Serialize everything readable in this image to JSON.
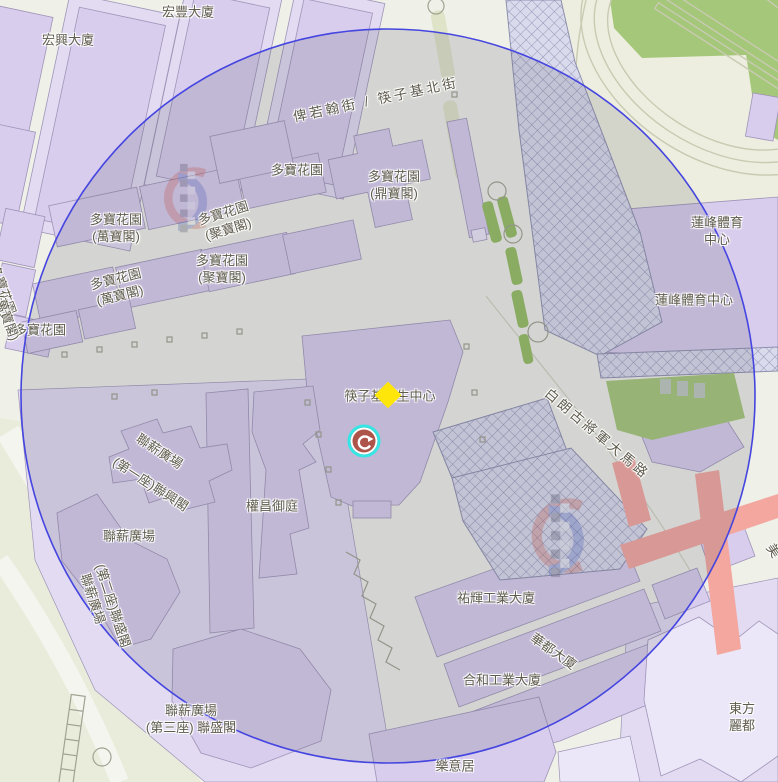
{
  "app": {
    "description": "street map with search radius"
  },
  "map": {
    "colors": {
      "base": "#EFF0E8",
      "ground": "#E9ECDB",
      "roadl": "#F4F5EE",
      "pod": "#E2DBF2",
      "bldg": "#D8CDED",
      "tower": "#ECE7F8",
      "bstroke": "#9F94B8",
      "track": "#C9CAB2",
      "green": "#A5C779",
      "gstrip": "#94BD62",
      "treegreen": "#DFE4C9",
      "hatchbg": "#D9DAEB",
      "hatchline": "#9597B8",
      "pink": "#F3A79F",
      "label": "#5F5B4D",
      "circleStroke": "#4545E0",
      "circleFill": "rgba(85,85,98,0.17)",
      "diamond": "#FFE60A",
      "ring": "#35E6E4",
      "poi": "#AD544B",
      "wmRed": "#D5503F",
      "wmBlue": "#4059C0",
      "furniture": "#A0A292"
    },
    "radius_circle": {
      "cx": 388,
      "cy": 396,
      "r": 367
    },
    "markers": {
      "diamond": {
        "x": 388,
        "y": 395
      },
      "poi": {
        "x": 364,
        "y": 441
      }
    },
    "watermarks": [
      {
        "x": 142,
        "y": 162,
        "scale": 0.95
      },
      {
        "x": 505,
        "y": 492,
        "scale": 1.15
      }
    ],
    "labels": [
      {
        "t": [
          "宏興大廈"
        ],
        "x": 68,
        "y": 41,
        "r": 0,
        "cls": "bld"
      },
      {
        "t": [
          "宏豐大廈"
        ],
        "x": 188,
        "y": 13,
        "r": 0,
        "cls": "bld"
      },
      {
        "t": [
          "多寶花園"
        ],
        "x": 297,
        "y": 171,
        "r": 0,
        "cls": "bld"
      },
      {
        "t": [
          "多寶花園",
          "(鼎寶閣)"
        ],
        "x": 394,
        "y": 186,
        "r": 0,
        "cls": "bld"
      },
      {
        "t": [
          "多寶花園",
          "(萬寶閣)"
        ],
        "x": 116,
        "y": 229,
        "r": 0,
        "cls": "bld"
      },
      {
        "t": [
          "多寶花園",
          "(聚寶閣)"
        ],
        "x": 226,
        "y": 222,
        "r": -17,
        "cls": "bld"
      },
      {
        "t": [
          "多寶花園",
          "(萬寶閣)"
        ],
        "x": 118,
        "y": 288,
        "r": -14,
        "cls": "bld"
      },
      {
        "t": [
          "多寶花園",
          "(聚寶閣)"
        ],
        "x": 222,
        "y": 270,
        "r": 0,
        "cls": "bld"
      },
      {
        "t": [
          "多寶花園"
        ],
        "x": 40,
        "y": 331,
        "r": 0,
        "cls": "bld"
      },
      {
        "t": [
          "多寶花園"
        ],
        "x": 2,
        "y": 290,
        "r": 70,
        "cls": "bld"
      },
      {
        "t": [
          "(萬寶閣)"
        ],
        "x": 6,
        "y": 318,
        "r": 70,
        "cls": "bld"
      },
      {
        "t": [
          "筷子基衛生中心"
        ],
        "x": 390,
        "y": 397,
        "r": 0,
        "cls": "bld"
      },
      {
        "t": [
          "權昌御庭"
        ],
        "x": 272,
        "y": 507,
        "r": 0,
        "cls": "bld"
      },
      {
        "t": [
          "聯薪廣場"
        ],
        "x": 159,
        "y": 452,
        "r": 33,
        "cls": "bld"
      },
      {
        "t": [
          "(第一座)聯興閣"
        ],
        "x": 150,
        "y": 485,
        "r": 33,
        "cls": "bld"
      },
      {
        "t": [
          "聯薪廣場"
        ],
        "x": 129,
        "y": 537,
        "r": 0,
        "cls": "bld"
      },
      {
        "t": [
          "聯薪廣場"
        ],
        "x": 92,
        "y": 599,
        "r": 72,
        "cls": "bld"
      },
      {
        "t": [
          "(第二座)聯盛閣"
        ],
        "x": 112,
        "y": 606,
        "r": 72,
        "cls": "bld"
      },
      {
        "t": [
          "聯薪廣場",
          "(第三座) 聯盛閣"
        ],
        "x": 191,
        "y": 720,
        "r": 0,
        "cls": "bld"
      },
      {
        "t": [
          "蓮峰體育中心"
        ],
        "x": 717,
        "y": 232,
        "r": 0,
        "cls": "bld"
      },
      {
        "t": [
          "蓮峰體育中心"
        ],
        "x": 694,
        "y": 301,
        "r": 0,
        "cls": "bld"
      },
      {
        "t": [
          "祐輝工業大廈"
        ],
        "x": 496,
        "y": 599,
        "r": 0,
        "cls": "bld"
      },
      {
        "t": [
          "華都大廈"
        ],
        "x": 553,
        "y": 652,
        "r": 35,
        "cls": "bld"
      },
      {
        "t": [
          "合和工業大廈"
        ],
        "x": 502,
        "y": 681,
        "r": 0,
        "cls": "bld"
      },
      {
        "t": [
          "樂意居"
        ],
        "x": 455,
        "y": 767,
        "r": 0,
        "cls": "bld"
      },
      {
        "t": [
          "東方麗都"
        ],
        "x": 742,
        "y": 718,
        "r": 0,
        "cls": "bld"
      },
      {
        "t": [
          "俾若翰街 / 筷子基北街"
        ],
        "x": 376,
        "y": 100,
        "r": -12,
        "cls": "street"
      },
      {
        "t": [
          "白朗古將軍大馬路"
        ],
        "x": 597,
        "y": 434,
        "r": 40,
        "cls": "street"
      },
      {
        "t": [
          "美"
        ],
        "x": 774,
        "y": 552,
        "r": 55,
        "cls": "street"
      }
    ]
  }
}
